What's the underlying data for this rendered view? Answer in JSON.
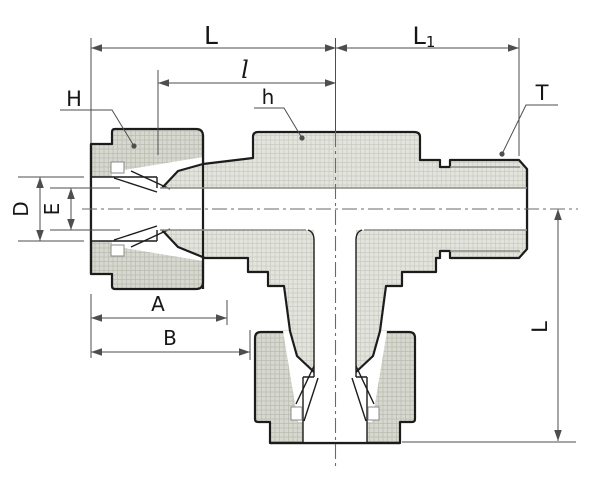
{
  "figure": {
    "description": "Cross-section technical drawing of a male branch tee compression tube fitting with two nut/ferrule tube ends (left and bottom) and one male threaded end (right)"
  },
  "dimension_labels": {
    "run_length": "L",
    "branch_to_end": {
      "main": "L",
      "sub": "1"
    },
    "tube_insertion": "l",
    "nut_hex": "H",
    "body_hex": "h",
    "thread": "T",
    "hole_diameter": "D",
    "bore_diameter": "E",
    "nut_length": "A",
    "branch_offset": "B",
    "branch_length": "L"
  },
  "colors": {
    "background": "#ffffff",
    "line": "#1c1c1c",
    "dim_line": "#4e4e4e",
    "label": "#161616",
    "bore_line": "#8b8b85",
    "centerline": "#6a6a66",
    "body_fill": "#e3e4dd",
    "body_hatch": "#c9cbc1",
    "nut_fill": "#d7d9d0",
    "nut_hatch": "#b9bcb0"
  }
}
